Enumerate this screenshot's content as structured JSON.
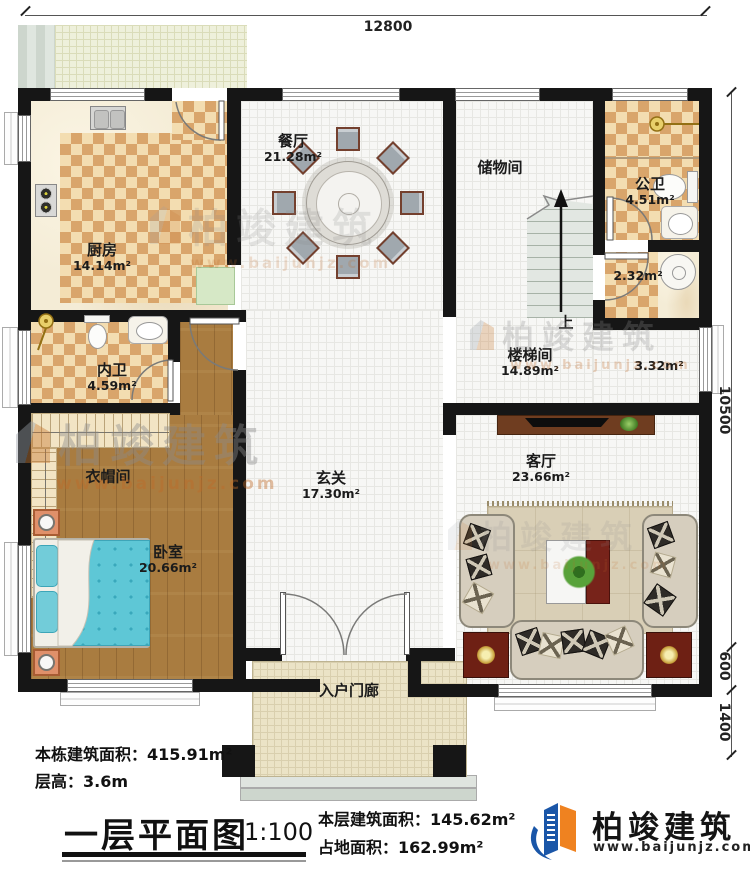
{
  "dimensions": {
    "width": "12800",
    "height": "10500",
    "step": "600",
    "porch": "1400"
  },
  "rooms": {
    "dining": {
      "name": "餐厅",
      "area": "21.28m²"
    },
    "kitchen": {
      "name": "厨房",
      "area": "14.14m²"
    },
    "storage": {
      "name": "储物间"
    },
    "public_bath": {
      "name": "公卫",
      "area": "4.51m²"
    },
    "vanity": {
      "area": "2.32m²"
    },
    "stair_hall": {
      "name": "楼梯间",
      "area": "14.89m²"
    },
    "nook": {
      "area": "3.32m²"
    },
    "private_bath": {
      "name": "内卫",
      "area": "4.59m²"
    },
    "cloakroom": {
      "name": "衣帽间"
    },
    "bedroom": {
      "name": "卧室",
      "area": "20.66m²"
    },
    "foyer": {
      "name": "玄关",
      "area": "17.30m²"
    },
    "living": {
      "name": "客厅",
      "area": "23.66m²"
    },
    "porch": {
      "name": "入户门廊"
    }
  },
  "stairs": {
    "direction": "上"
  },
  "info": {
    "total_area": "本栋建筑面积：415.91m²",
    "floor_height": "层高：3.6m",
    "floor_area": "本层建筑面积：145.62m²",
    "footprint": "占地面积：162.99m²"
  },
  "title": {
    "name": "一层平面图",
    "scale": "1:100"
  },
  "brand": {
    "name": "柏竣建筑",
    "website": "www.baijunjz.com",
    "icon": "building-logo-icon"
  },
  "watermark": {
    "text": "柏竣建筑",
    "website": "www.baijunjz.com",
    "icon": "building-logo-icon"
  }
}
